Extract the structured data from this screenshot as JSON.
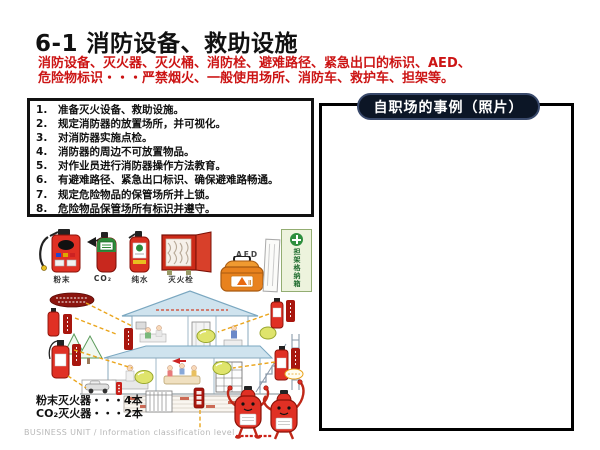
{
  "slide": {
    "title": "6-1 消防设备、救助设施",
    "subtitle_line1": "消防设备、灭火器、灭火桶、消防栓、避难路径、紧急出口的标识、AED、",
    "subtitle_line2": "危险物标识・・・严禁烟火、一般使用场所、消防车、救护车、担架等。"
  },
  "checklist": {
    "items": [
      "准备灭火设备、救助设施。",
      "规定消防器的放置场所，并可视化。",
      "对消防器实施点检。",
      "消防器的周边不可放置物品。",
      "对作业员进行消防器操作方法教育。",
      "有避难路径、紧急出口标识、确保避难路畅通。",
      "规定危险物品的保管场所并上锁。",
      "危险物品保管场所有标识并遵守。"
    ]
  },
  "equipment": {
    "labels": [
      "粉末",
      "CO₂",
      "纯水",
      "灭火栓"
    ],
    "aed_label": "AED",
    "sign_text": "担架格纳箱"
  },
  "counts": {
    "line1": "粉末灭火器・・・4本",
    "line2": "CO₂灭火器・・・2本"
  },
  "photo_panel": {
    "header": "自职场的事例（照片）"
  },
  "footer": {
    "text": "BUSINESS UNIT / Information classification level"
  },
  "colors": {
    "title_text": "#111111",
    "subtitle_red": "#cc1414",
    "pill_background": "#0c1626",
    "extinguisher_red": "#e03024",
    "co2_green": "#2e8b3a",
    "hydrant_red": "#cc2a18",
    "aed_orange": "#e8821e",
    "sign_green": "#2e8f3e",
    "dashed_line_orange": "#eaa51c",
    "roof_blue": "#cfe3ee"
  }
}
